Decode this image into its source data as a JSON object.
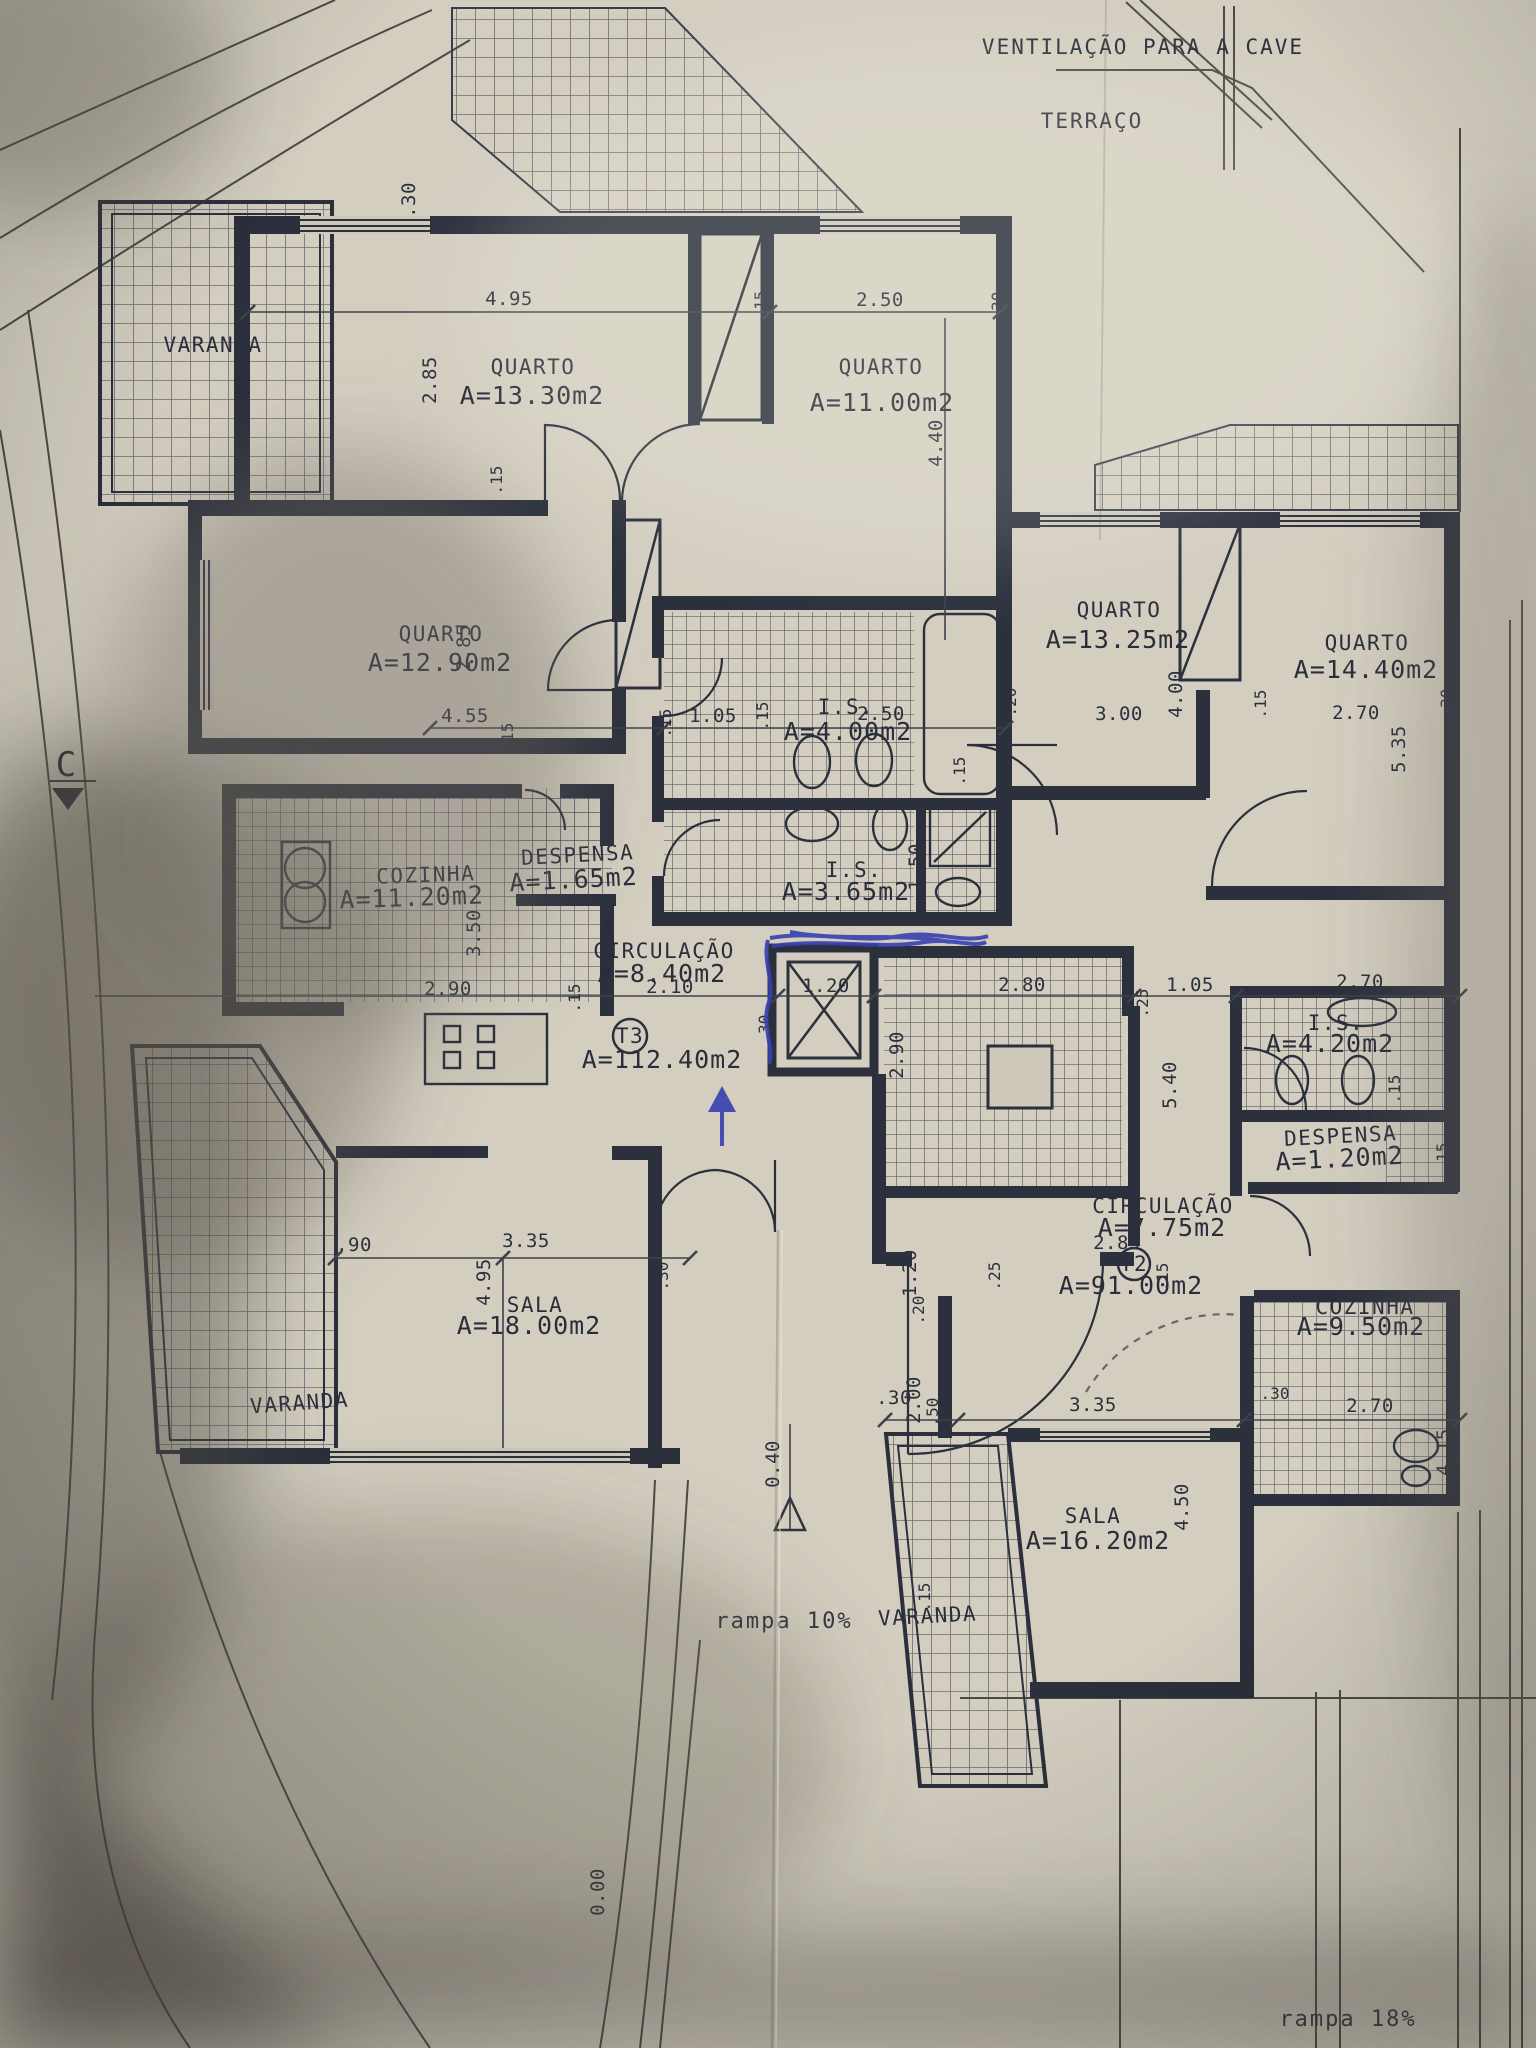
{
  "site": {
    "ventilation_note": "VENTILAÇÃO PARA A CAVE",
    "terrace_label": "TERRAÇO",
    "ramp_10": "rampa 10%",
    "ramp_18": "rampa 18%",
    "level_entry": "0.40",
    "level_zero": "0.00",
    "section_mark": "C"
  },
  "units": {
    "t3_id": "T3",
    "t3_area": "A=112.40m2",
    "t2_id": "T2",
    "t2_area": "A=91.00m2"
  },
  "rooms": [
    {
      "name": "VARANDA",
      "area": ""
    },
    {
      "name": "QUARTO",
      "area": "A=13.30m2"
    },
    {
      "name": "QUARTO",
      "area": "A=11.00m2"
    },
    {
      "name": "QUARTO",
      "area": "A=12.90m2"
    },
    {
      "name": "QUARTO",
      "area": "A=13.25m2"
    },
    {
      "name": "QUARTO",
      "area": "A=14.40m2"
    },
    {
      "name": "COZINHA",
      "area": "A=11.20m2"
    },
    {
      "name": "DESPENSA",
      "area": "A=1.65m2"
    },
    {
      "name": "I.S.",
      "area": "A=4.00m2"
    },
    {
      "name": "I.S.",
      "area": "A=3.65m2"
    },
    {
      "name": "CIRCULAÇÃO",
      "area": "A=8.40m2"
    },
    {
      "name": "SALA",
      "area": "A=18.00m2"
    },
    {
      "name": "VARANDA",
      "area": ""
    },
    {
      "name": "I.S.",
      "area": "A=4.20m2"
    },
    {
      "name": "DESPENSA",
      "area": "A=1.20m2"
    },
    {
      "name": "CIRCULAÇÃO",
      "area": "A=7.75m2"
    },
    {
      "name": "COZINHA",
      "area": "A=9.50m2"
    },
    {
      "name": "SALA",
      "area": "A=16.20m2"
    },
    {
      "name": "VARANDA",
      "area": ""
    }
  ],
  "dims": [
    {
      "v": ".30"
    },
    {
      "v": "4.95"
    },
    {
      "v": "2.85"
    },
    {
      "v": ".15"
    },
    {
      "v": "2.50"
    },
    {
      "v": ".30"
    },
    {
      "v": "4.40"
    },
    {
      "v": ".15"
    },
    {
      "v": "2.85"
    },
    {
      "v": "4.55"
    },
    {
      "v": ".15"
    },
    {
      "v": ".15"
    },
    {
      "v": "1.05"
    },
    {
      "v": ".15"
    },
    {
      "v": "2.50"
    },
    {
      "v": ".20"
    },
    {
      "v": "3.00"
    },
    {
      "v": "4.00"
    },
    {
      "v": ".15"
    },
    {
      "v": "2.70"
    },
    {
      "v": "5.35"
    },
    {
      "v": ".30"
    },
    {
      "v": "2.90"
    },
    {
      "v": ".15"
    },
    {
      "v": "3.50"
    },
    {
      "v": "2.10"
    },
    {
      "v": "1.20"
    },
    {
      "v": ".30"
    },
    {
      "v": "2.80"
    },
    {
      "v": "1.05"
    },
    {
      "v": ".25"
    },
    {
      "v": "2.70"
    },
    {
      "v": "2.90"
    },
    {
      "v": "5.40"
    },
    {
      "v": "1.50"
    },
    {
      "v": ".15"
    },
    {
      "v": ".15"
    },
    {
      "v": ".15"
    },
    {
      "v": "2.85"
    },
    {
      "v": ".25"
    },
    {
      "v": "1.20"
    },
    {
      "v": ".20"
    },
    {
      "v": ".15"
    },
    {
      "v": ".30"
    },
    {
      "v": "2.00"
    },
    {
      "v": ".50"
    },
    {
      "v": "3.35"
    },
    {
      "v": ".30"
    },
    {
      "v": "2.70"
    },
    {
      "v": "4.15"
    },
    {
      "v": "4.50"
    },
    {
      "v": ".15"
    },
    {
      "v": ".90"
    },
    {
      "v": "3.35"
    },
    {
      "v": "4.95"
    },
    {
      "v": ".30"
    }
  ]
}
